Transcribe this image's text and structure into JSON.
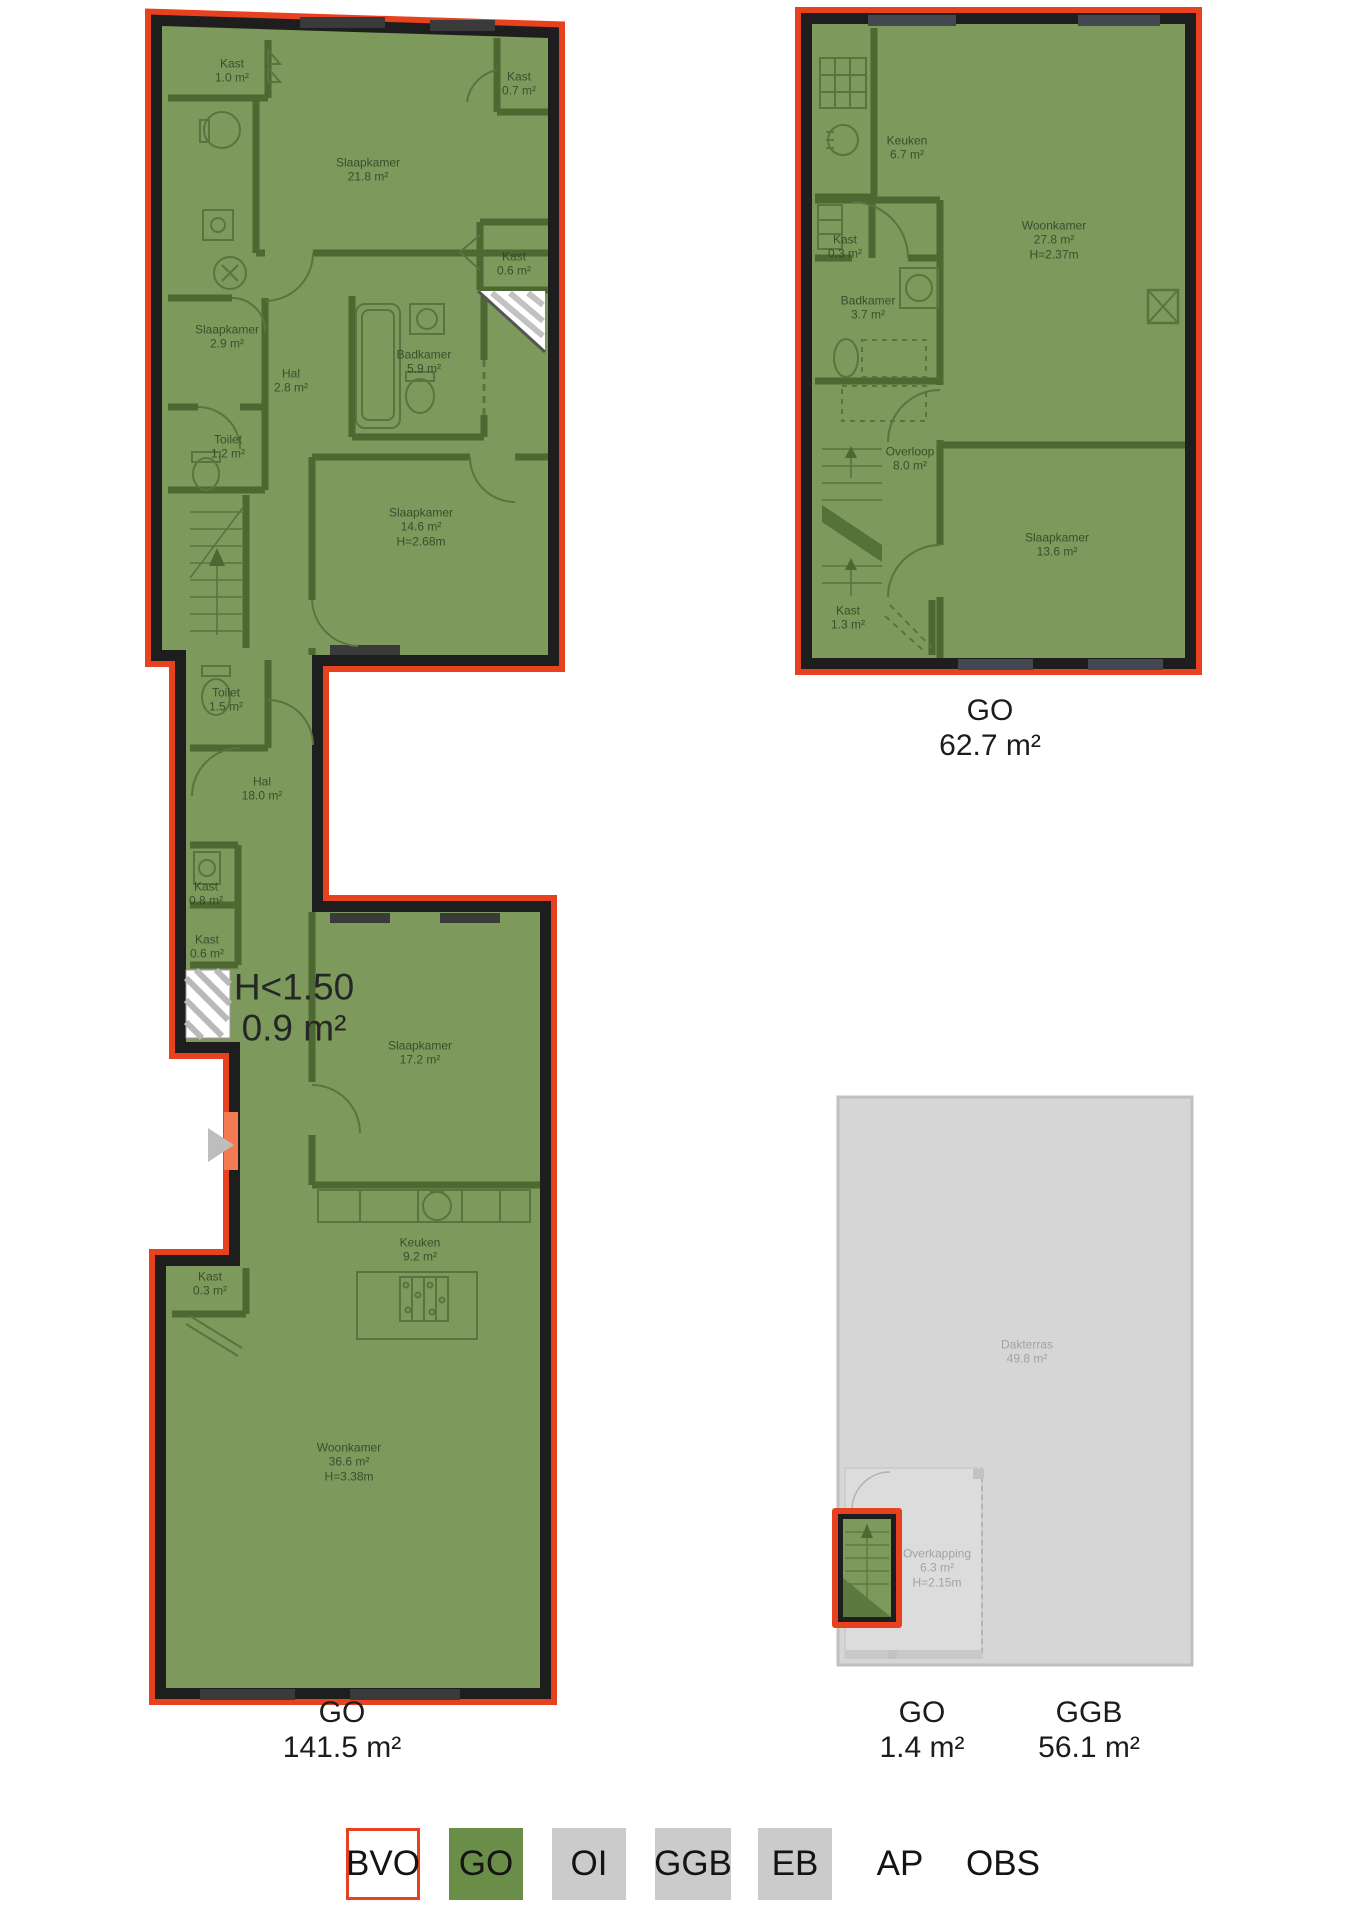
{
  "palette": {
    "bvo_red": "#e8411f",
    "go_green": "#6a8e48",
    "overlay_green": "#7d995c",
    "interior_wall_green": "#4d6830",
    "wall_black": "#1e1e1e",
    "gray_area": "#d6d6d6",
    "legend_gray": "#cbcbcb"
  },
  "plans": [
    {
      "name": "first-floor",
      "rooms": [
        {
          "lines": [
            "Kast",
            "1.0 m²"
          ],
          "x": 232,
          "y": 71
        },
        {
          "lines": [
            "Kast",
            "0.7 m²"
          ],
          "x": 519,
          "y": 84
        },
        {
          "lines": [
            "Slaapkamer",
            "21.8 m²"
          ],
          "x": 368,
          "y": 170
        },
        {
          "lines": [
            "Kast",
            "0.6 m²"
          ],
          "x": 514,
          "y": 264
        },
        {
          "lines": [
            "Slaapkamer",
            "2.9 m²"
          ],
          "x": 227,
          "y": 337
        },
        {
          "lines": [
            "Hal",
            "2.8 m²"
          ],
          "x": 291,
          "y": 381
        },
        {
          "lines": [
            "Badkamer",
            "5.9 m²"
          ],
          "x": 424,
          "y": 362
        },
        {
          "lines": [
            "Toilet",
            "1.2 m²"
          ],
          "x": 228,
          "y": 447
        },
        {
          "lines": [
            "Slaapkamer",
            "14.6 m²",
            "H=2.68m"
          ],
          "x": 421,
          "y": 527
        },
        {
          "lines": [
            "Toilet",
            "1.5 m²"
          ],
          "x": 226,
          "y": 700
        },
        {
          "lines": [
            "Hal",
            "18.0 m²"
          ],
          "x": 262,
          "y": 789
        },
        {
          "lines": [
            "Kast",
            "0.8 m²"
          ],
          "x": 206,
          "y": 894
        },
        {
          "lines": [
            "Kast",
            "0.6 m²"
          ],
          "x": 207,
          "y": 947
        },
        {
          "lines": [
            "H<1.50",
            "0.9 m²"
          ],
          "x": 294,
          "y": 1008,
          "cls": "big"
        },
        {
          "lines": [
            "Slaapkamer",
            "17.2 m²"
          ],
          "x": 420,
          "y": 1053
        },
        {
          "lines": [
            "Keuken",
            "9.2 m²"
          ],
          "x": 420,
          "y": 1250
        },
        {
          "lines": [
            "Kast",
            "0.3 m²"
          ],
          "x": 210,
          "y": 1284
        },
        {
          "lines": [
            "Woonkamer",
            "36.6 m²",
            "H=3.38m"
          ],
          "x": 349,
          "y": 1462
        }
      ]
    },
    {
      "name": "second-floor",
      "rooms": [
        {
          "lines": [
            "Keuken",
            "6.7 m²"
          ],
          "x": 907,
          "y": 148
        },
        {
          "lines": [
            "Woonkamer",
            "27.8 m²",
            "H=2.37m"
          ],
          "x": 1054,
          "y": 240
        },
        {
          "lines": [
            "Kast",
            "0.3 m²"
          ],
          "x": 845,
          "y": 247
        },
        {
          "lines": [
            "Badkamer",
            "3.7 m²"
          ],
          "x": 868,
          "y": 308
        },
        {
          "lines": [
            "Overloop",
            "8.0 m²"
          ],
          "x": 910,
          "y": 459
        },
        {
          "lines": [
            "Slaapkamer",
            "13.6 m²"
          ],
          "x": 1057,
          "y": 545
        },
        {
          "lines": [
            "Kast",
            "1.3 m²"
          ],
          "x": 848,
          "y": 618
        }
      ]
    },
    {
      "name": "roof-terrace",
      "rooms": [
        {
          "lines": [
            "Dakterras",
            "49.8 m²"
          ],
          "x": 1027,
          "y": 1352,
          "cls": "gray"
        },
        {
          "lines": [
            "Overkapping",
            "6.3 m²",
            "H=2.15m"
          ],
          "x": 937,
          "y": 1568,
          "cls": "gray"
        }
      ]
    }
  ],
  "area_labels": [
    {
      "title": "GO",
      "value": "141.5 m²",
      "x": 342,
      "y": 1731
    },
    {
      "title": "GO",
      "value": "62.7 m²",
      "x": 990,
      "y": 729
    },
    {
      "title": "GO",
      "value": "1.4 m²",
      "x": 922,
      "y": 1731
    },
    {
      "title": "GGB",
      "value": "56.1 m²",
      "x": 1089,
      "y": 1731
    }
  ],
  "legend": {
    "items": [
      {
        "code": "BVO",
        "fill": "#ffffff",
        "border": "#e8411f"
      },
      {
        "code": "GO",
        "fill": "#6a8e48",
        "border": null
      },
      {
        "code": "OI",
        "fill": "#cbcbcb",
        "border": null
      },
      {
        "code": "GGB",
        "fill": "#cbcbcb",
        "border": null
      },
      {
        "code": "EB",
        "fill": "#cbcbcb",
        "border": null
      },
      {
        "code": "AP",
        "fill": null,
        "border": null
      },
      {
        "code": "OBS",
        "fill": null,
        "border": null
      }
    ]
  }
}
